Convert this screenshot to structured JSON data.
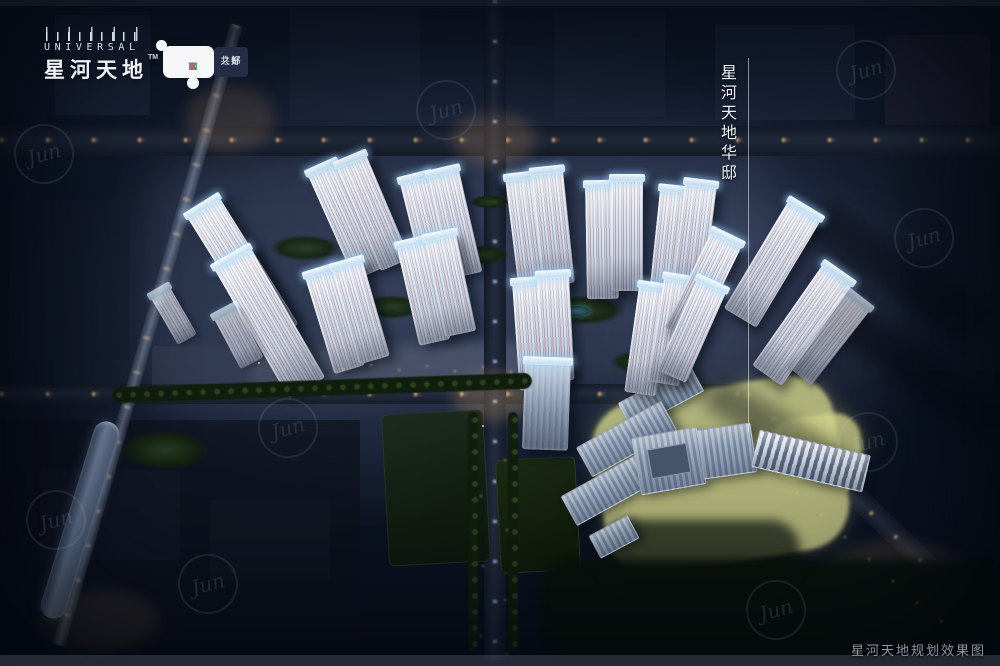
{
  "brand": {
    "logo_top": "UNIVERSAL",
    "logo_main": "星河天地",
    "trademark": "TM",
    "badge": {
      "city_letters": [
        "C",
        "I",
        "T",
        "Y"
      ],
      "max_letters": [
        "M",
        "A",
        "X"
      ],
      "tagline_top": "共好",
      "tagline_bottom": "之都",
      "letter_colors": {
        "C": "#e2483d",
        "I": "#eda33b",
        "T": "#1ea08a",
        "Y": "#d44553",
        "M": "#3da653",
        "A": "#2f7fc2",
        "X": "#e2586f"
      }
    }
  },
  "labels": {
    "tower_annotation": "星河天地华邸",
    "caption": "星河天地规划效果图"
  },
  "watermark": {
    "text": "Jun"
  },
  "palette": {
    "night_base": "#0e1726",
    "roof_glow": "#c9e6f8",
    "facade": "#dfe6ee",
    "facade_accent": "#c2919c",
    "site_highlight": "#d8db8e",
    "warm_light": "#ffc37d",
    "cool_light": "#bcd4ff"
  }
}
